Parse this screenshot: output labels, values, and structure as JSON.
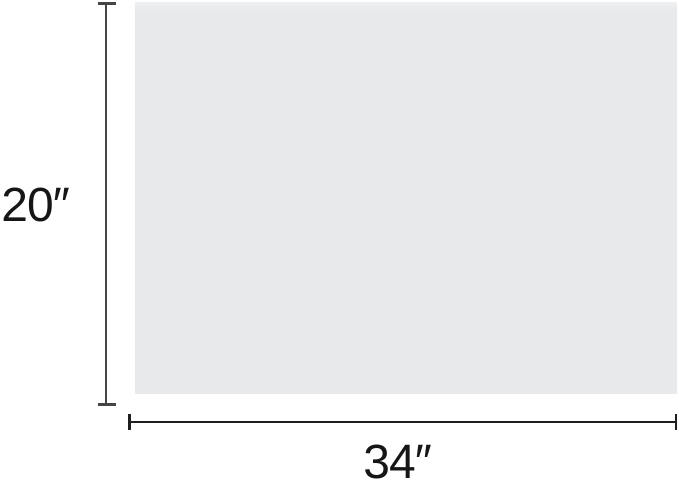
{
  "diagram": {
    "type": "rectangle-dimension-diagram",
    "height_dimension": {
      "label": "20″",
      "value": 20,
      "unit_symbol": "″"
    },
    "width_dimension": {
      "label": "34″",
      "value": 34,
      "unit_symbol": "″"
    },
    "colors": {
      "background": "#ffffff",
      "panel_fill": "#e8e9ea",
      "panel_fill_top": "#eff0f1",
      "vertical_line": "#454545",
      "horizontal_line": "#1f1f1f",
      "text": "#161616"
    }
  }
}
